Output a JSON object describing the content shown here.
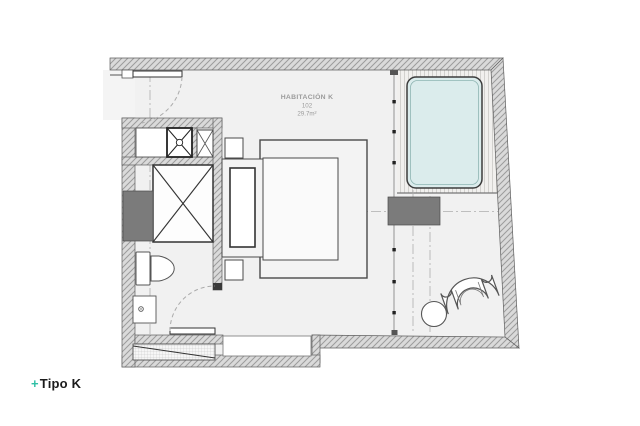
{
  "room": {
    "name": "HABITACIÓN K",
    "number": "102",
    "area": "29.7m²"
  },
  "footer": {
    "plus": "+",
    "label": "Tipo K"
  },
  "colors": {
    "accent_teal": "#2fbfa5",
    "tub_fill": "#dbecec",
    "floor_fill": "#f1f1f1",
    "wall_hatch_bg": "#dadada",
    "wall_hatch_line": "#9c9c9c",
    "dark_block": "#7b7b7b",
    "label_gray": "#9b9b9b",
    "ink": "#1b1b1b"
  }
}
